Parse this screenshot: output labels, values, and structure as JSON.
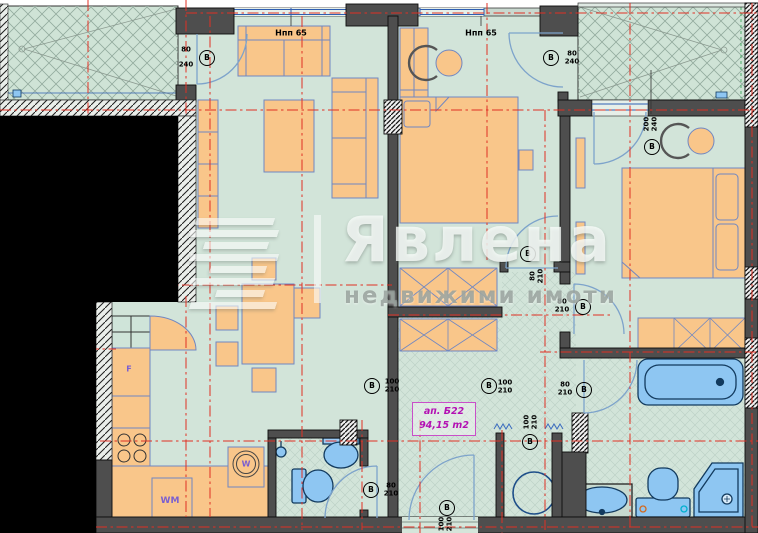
{
  "watermark": {
    "brand": "Явлена",
    "tagline": "недвижими имоти"
  },
  "apartment_label": {
    "line1": "ап. Б22",
    "line2": "94,15 m2"
  },
  "door_circle_letter": "В",
  "window_labels": [
    {
      "name": "parapet-label-left",
      "text": "Нпп 65",
      "x": 291,
      "y": 33
    },
    {
      "name": "parapet-label-right",
      "text": "Нпп 65",
      "x": 481,
      "y": 33
    }
  ],
  "door_labels": [
    {
      "name": "terrace-left-door-label",
      "top": "80",
      "bottom": "240",
      "fx": 186,
      "fy": 58,
      "cx": 207,
      "cy": 58,
      "ext": true
    },
    {
      "name": "bed1-terrace-door-label",
      "top": "80",
      "bottom": "240",
      "fx": 572,
      "fy": 58,
      "cx": 551,
      "cy": 58
    },
    {
      "name": "bed2-window-label",
      "top": "200",
      "bottom": "240",
      "fx": 651,
      "fy": 124,
      "cx": 652,
      "cy": 147,
      "rot": true
    },
    {
      "name": "bed1-hall-door-label",
      "top": "80",
      "bottom": "210",
      "fx": 537,
      "fy": 276,
      "cx": 528,
      "cy": 254,
      "rot": true
    },
    {
      "name": "bed2-hall-door-label",
      "top": "80",
      "bottom": "210",
      "fx": 562,
      "fy": 306,
      "cx": 583,
      "cy": 307
    },
    {
      "name": "hall-passage-label",
      "top": "100",
      "bottom": "210",
      "fx": 505,
      "fy": 387,
      "cx": 489,
      "cy": 386
    },
    {
      "name": "hall-left-passage-label",
      "top": "100",
      "bottom": "210",
      "fx": 392,
      "fy": 386,
      "cx": 372,
      "cy": 386
    },
    {
      "name": "bath-door-label",
      "top": "80",
      "bottom": "210",
      "fx": 565,
      "fy": 389,
      "cx": 584,
      "cy": 390
    },
    {
      "name": "storage-opening-label",
      "top": "100",
      "bottom": "210",
      "fx": 531,
      "fy": 422,
      "cx": 530,
      "cy": 442,
      "rot": true
    },
    {
      "name": "wc-door-label",
      "top": "80",
      "bottom": "210",
      "fx": 391,
      "fy": 490,
      "cx": 371,
      "cy": 490
    },
    {
      "name": "entrance-door-label",
      "top": "100",
      "bottom": "210",
      "fx": 446,
      "fy": 524,
      "cx": 447,
      "cy": 508,
      "rot": true
    }
  ],
  "room_texts": [
    {
      "name": "fridge-label",
      "text": "F",
      "x": 129,
      "y": 369,
      "size": 8
    },
    {
      "name": "washing-machine-label",
      "text": "WM",
      "x": 170,
      "y": 501,
      "size": 9
    },
    {
      "name": "kitchen-sink-label",
      "text": "W",
      "x": 246,
      "y": 464,
      "size": 8
    }
  ],
  "colors": {
    "room_green": "#d2e4d9",
    "terrace_green": "#cfe3d6",
    "wall_gray": "#4e4e4e",
    "furniture_orange": "#f9c68a",
    "furniture_line_blue": "#7087c2",
    "fixture_blue": "#8ec6f2",
    "axis_red": "#e03024",
    "apartment_magenta": "#b311b3",
    "appliance_purple": "#7a5fd0",
    "door_arc_blue": "#7da3cb",
    "window_blue": "#2f5fb3"
  }
}
